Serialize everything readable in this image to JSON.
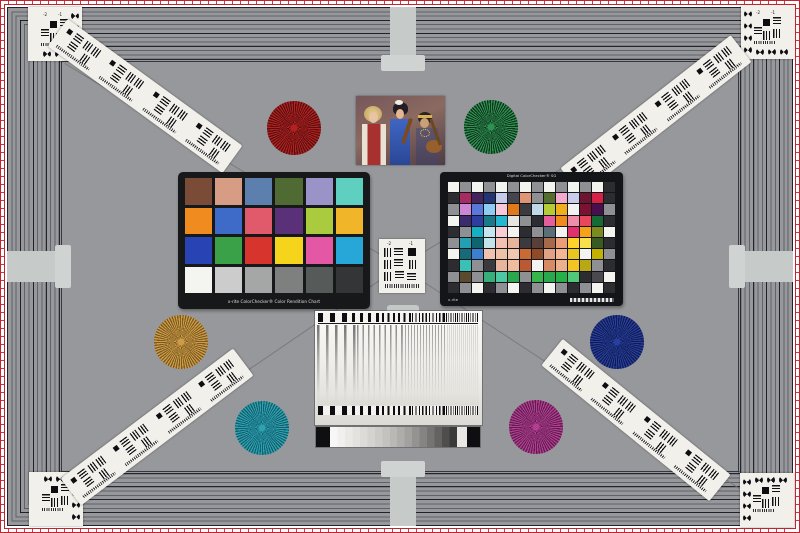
{
  "scene": {
    "name": "camera-resolution-test-chart"
  },
  "palette": {
    "background": "#97989b",
    "frame_line": "#33343c",
    "border_red": "#c2232e",
    "cross_gray": "#c6cac9",
    "card_white": "#f1f0ea"
  },
  "corner_targets": {
    "numbers": [
      "-2",
      "-1"
    ]
  },
  "center_target": {
    "numbers": [
      "-2",
      "-1"
    ]
  },
  "stars": [
    {
      "id": "red",
      "name": "red-siemens-star",
      "color": "#b32121",
      "dark": "#55100f"
    },
    {
      "id": "green",
      "name": "green-siemens-star",
      "color": "#2f9152",
      "dark": "#10341c"
    },
    {
      "id": "orange",
      "name": "orange-siemens-star",
      "color": "#cd9c48",
      "dark": "#7c5a20"
    },
    {
      "id": "blue",
      "name": "blue-siemens-star",
      "color": "#283ea0",
      "dark": "#111c4e"
    },
    {
      "id": "teal",
      "name": "teal-siemens-star",
      "color": "#2fa2b2",
      "dark": "#135f6c"
    },
    {
      "id": "magenta",
      "name": "magenta-siemens-star",
      "color": "#b53e92",
      "dark": "#5e1f50"
    }
  ],
  "colorchecker24": {
    "label": "x-rite ColorChecker® Color Rendition Chart",
    "colors": [
      "#7a4b36",
      "#d79d84",
      "#5c7fae",
      "#4f6b33",
      "#9a93c8",
      "#5fd0c0",
      "#ef8b1f",
      "#3f6bc8",
      "#e05a6b",
      "#5a3178",
      "#aacb3e",
      "#f0b529",
      "#2743b4",
      "#3aa148",
      "#d8342e",
      "#f5d41b",
      "#e457a5",
      "#27a6d8",
      "#f4f4f1",
      "#cbcccb",
      "#a5a7a6",
      "#7e8080",
      "#565a59",
      "#333536"
    ]
  },
  "colorchecker_sg": {
    "title": "Digital ColorChecker® SG",
    "logo": "x-rite",
    "rows": 10,
    "cols": 14,
    "palette": [
      "#f3f3ef",
      "#8f9093",
      "#f3f3ef",
      "#8f9093",
      "#f3f3ef",
      "#8f9093",
      "#f3f3ef",
      "#8f9093",
      "#f3f3ef",
      "#8f9093",
      "#f3f3ef",
      "#8f9093",
      "#f3f3ef",
      "#2d2d31",
      "#2d2d31",
      "#a82a62",
      "#44245c",
      "#223472",
      "#c5cbe9",
      "#45454d",
      "#e09577",
      "#8f9093",
      "#556e2e",
      "#f2abca",
      "#c9cdea",
      "#6d1530",
      "#d62147",
      "#2d2d31",
      "#8f9093",
      "#cc86d6",
      "#5a78da",
      "#8ccdf1",
      "#f7c8d8",
      "#e07917",
      "#3b3b3f",
      "#c1d8e8",
      "#b5cc34",
      "#efb01b",
      "#f3f3ef",
      "#7c1232",
      "#47104c",
      "#8f9093",
      "#f3f3ef",
      "#3b2a6e",
      "#2e3ea0",
      "#1a7a8a",
      "#26b7d0",
      "#e8e5e0",
      "#8f9093",
      "#2d2d31",
      "#e45f9a",
      "#ef8b1f",
      "#f08da8",
      "#e8475b",
      "#156a35",
      "#2d2d31",
      "#2d2d31",
      "#8f9093",
      "#15b0c4",
      "#c5e6ee",
      "#f8cdd4",
      "#f3f3ef",
      "#2d2d31",
      "#8f9093",
      "#5a6f77",
      "#f3f3ef",
      "#e3306a",
      "#f5a21b",
      "#7a8c20",
      "#f3f3ef",
      "#8f9093",
      "#22a0b4",
      "#0f6470",
      "#c3e4ea",
      "#f2c1b2",
      "#e8b59a",
      "#3b3b3f",
      "#584038",
      "#a56a4a",
      "#eb9d77",
      "#ffd32a",
      "#f7e04a",
      "#3a5a24",
      "#2d2d31",
      "#f3f3ef",
      "#176a78",
      "#3a7fd0",
      "#f1c3ae",
      "#eec2a8",
      "#f0c6b0",
      "#c96a32",
      "#8f4a28",
      "#e0a184",
      "#f2b694",
      "#e8c81e",
      "#f3f3ef",
      "#c2b100",
      "#8f9093",
      "#2d2d31",
      "#39c1b8",
      "#8f9093",
      "#3a3a3e",
      "#e7b49e",
      "#f0bc9e",
      "#ba5a34",
      "#f3f3ef",
      "#d88a64",
      "#ecb08c",
      "#f5c422",
      "#b8a816",
      "#8f9093",
      "#2d2d31",
      "#8f9093",
      "#5a4a2e",
      "#8f9093",
      "#36b07a",
      "#4cc9a2",
      "#2aa84e",
      "#8f9093",
      "#35b54a",
      "#2aa84e",
      "#24b148",
      "#50c878",
      "#2d2d31",
      "#4a4a4e",
      "#f3f3ef",
      "#2d2d31",
      "#8f9093",
      "#f3f3ef",
      "#2d2d31",
      "#8f9093",
      "#f3f3ef",
      "#2d2d31",
      "#8f9093",
      "#f3f3ef",
      "#8f9093",
      "#2d2d31",
      "#8f9093",
      "#f3f3ef",
      "#2d2d31"
    ]
  },
  "wedge": {
    "steps": [
      "#f7f7f5",
      "#f1f0ee",
      "#eae9e6",
      "#e3e2df",
      "#dcdbd7",
      "#d4d3cf",
      "#cccbc7",
      "#c3c2be",
      "#b9b8b4",
      "#aeadaa",
      "#a2a19e",
      "#949391",
      "#858482",
      "#757473",
      "#646361",
      "#4f4e4d",
      "#3a3a39"
    ]
  }
}
